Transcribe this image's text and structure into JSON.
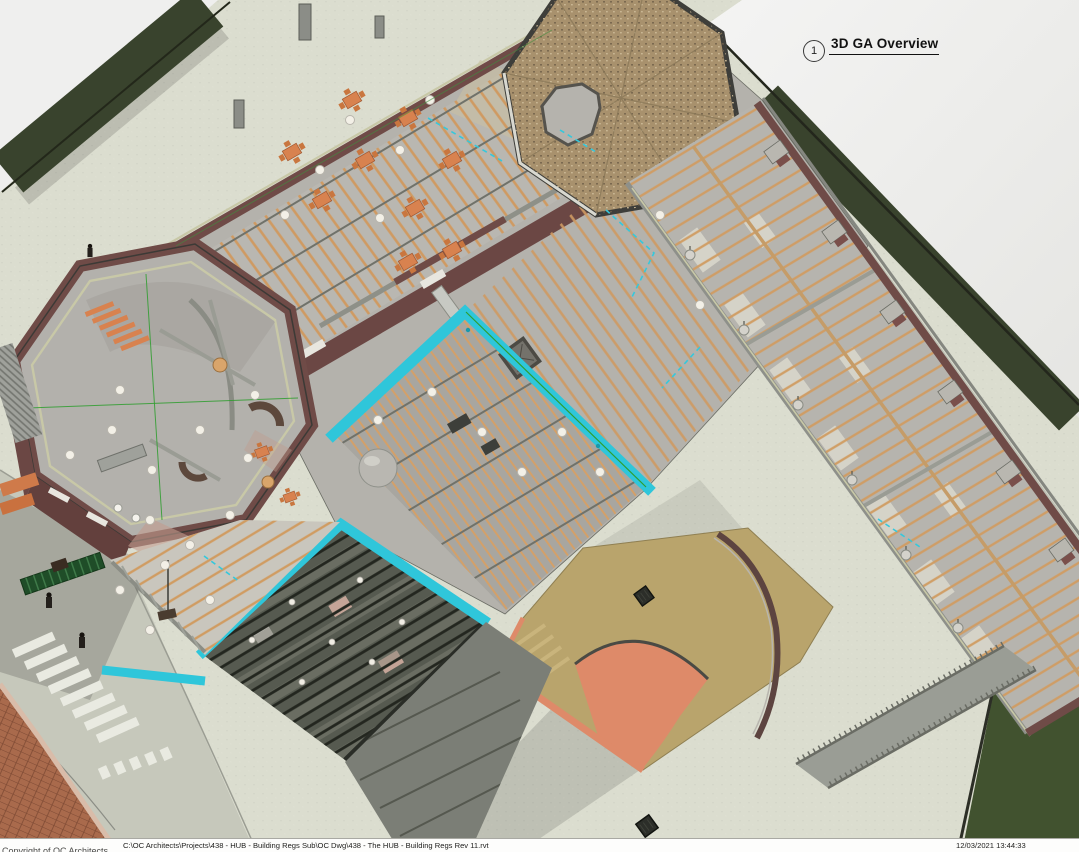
{
  "sheet": {
    "view_label": {
      "number": "1",
      "title": "3D GA Overview"
    },
    "footer": {
      "copyright": "Copyright of OC Architects",
      "file_path": "C:\\OC Architects\\Projects\\438 - HUB - Building Regs Sub\\OC Dwg\\438 - The HUB - Building Regs Rev 11.rvt",
      "timestamp": "12/03/2021 13:44:33"
    }
  },
  "scene": {
    "description": "3D axonometric cutaway GA overview of The HUB: octagonal pavilion, restaurant wing with orange tables, central kitchen under exposed timber joists with cyan-highlighted ring beams, shingled octagonal roof, long bedroom wing, tan terrace with orange arch, glazed dark-roof block, roads, pedestrian crossing, grass verges and two people.",
    "elements": [
      "octagonal-pavilion",
      "octagonal-shingle-roof",
      "restaurant-wing",
      "central-kitchen-block",
      "selected-ring-beams",
      "long-east-wing",
      "terrace-courtyard",
      "glazed-roof-block",
      "timber-frame-area",
      "access-ramp",
      "lawn",
      "pedestrian-crossing",
      "grass-verge",
      "people"
    ],
    "palette": {
      "page": "#efefee",
      "paving": "#dbddcf",
      "road": "#c6c8bb",
      "grass_dark": "#39432d",
      "lawn": "#41522f",
      "roof_shingle": "#a8916d",
      "wall_maroon": "#6f4b47",
      "wall_cap_olive": "#c8c8a7",
      "floor_gray": "#b4b2ac",
      "timber": "#cf9a62",
      "selection_cyan": "#2fc6da",
      "furniture_orange": "#d8824f",
      "terrace_tan": "#b9a46c",
      "arch_orange": "#de8a69",
      "glazed_roof": "#565a50"
    }
  }
}
